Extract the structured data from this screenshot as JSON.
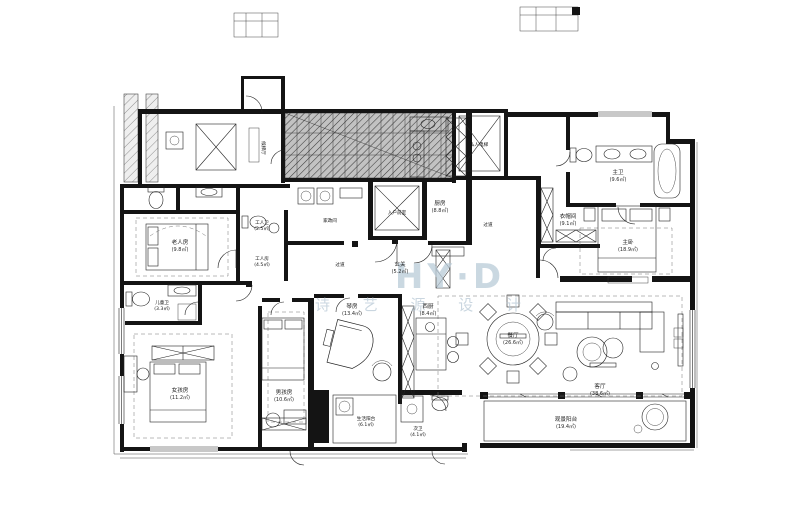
{
  "watermark": {
    "logo": "HY·D",
    "name": "诗 艺 源 设 计",
    "color": "#b4c6d3"
  },
  "rooms": {
    "elevator_hall": {
      "name": "候梯厅"
    },
    "private_elevator": {
      "name": "私人电梯"
    },
    "entry_foyer": {
      "name": "入户前室"
    },
    "laundry": {
      "name": "家政间"
    },
    "maid_bath": {
      "name": "工人卫",
      "area": "(2.5㎡)"
    },
    "maid_room": {
      "name": "工人房",
      "area": "(4.5㎡)"
    },
    "elder_room": {
      "name": "老人房",
      "area": "(9.8㎡)"
    },
    "kitchen": {
      "name": "厨房",
      "area": "(8.8㎡)"
    },
    "hall": {
      "name": "过道"
    },
    "hall2": {
      "name": "过道"
    },
    "foyer": {
      "name": "玄关",
      "area": "(5.2㎡)"
    },
    "closet": {
      "name": "衣帽间",
      "area": "(9.1㎡)"
    },
    "master_bath": {
      "name": "主卫",
      "area": "(9.6㎡)"
    },
    "master_bed": {
      "name": "主卧",
      "area": "(18.9㎡)"
    },
    "west_kitchen": {
      "name": "西厨",
      "area": "(8.4㎡)"
    },
    "dining": {
      "name": "餐厅",
      "area": "(26.6㎡)"
    },
    "living": {
      "name": "客厅",
      "area": "(38.6㎡)"
    },
    "piano_room": {
      "name": "琴房",
      "area": "(13.4㎡)"
    },
    "boy_room": {
      "name": "男孩房",
      "area": "(10.6㎡)"
    },
    "girl_room": {
      "name": "女孩房",
      "area": "(11.2㎡)"
    },
    "kids_bath": {
      "name": "儿童卫",
      "area": "(3.3㎡)"
    },
    "guest_bath": {
      "name": "次卫",
      "area": "(4.1㎡)"
    },
    "service_balcony": {
      "name": "生活阳台",
      "area": "(6.1㎡)"
    },
    "view_balcony": {
      "name": "观景阳台",
      "area": "(19.4㎡)"
    }
  },
  "colors": {
    "wall": "#141414",
    "hatch_bg": "#c2c2c2",
    "watermark": "#b4c6d3"
  }
}
